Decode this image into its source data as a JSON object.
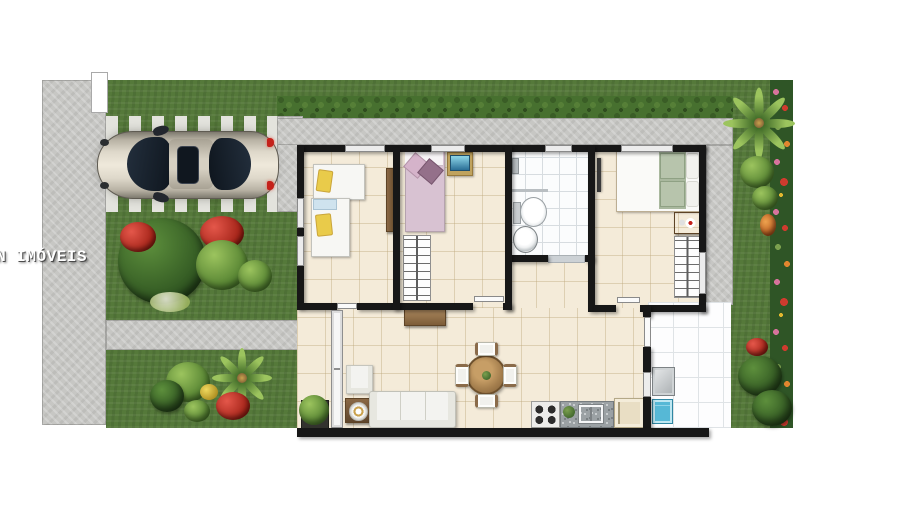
{
  "watermark": {
    "text": "ON IMÓVEIS"
  },
  "palette": {
    "background": "#ffffff",
    "lawn_green": "#55793a",
    "hedge_green": "#2f5526",
    "concrete_gray": "#c7c7c4",
    "paver_white": "#e3e3dd",
    "wall_black": "#171717",
    "floor_beige": "#f4ebd9",
    "tile_white": "#fbfcfd",
    "wood_brown": "#8a6b4a",
    "bed_pink": "#d8c2d2",
    "bed_sage": "#a9b89e",
    "pillow_yellow": "#e9cb4a",
    "sofa_white": "#f3f3f0",
    "washer_blue": "#56b8d6",
    "flower_red": "#cf3b2e",
    "flower_pink": "#d7739c",
    "flower_orange": "#e2862f",
    "car_champagne": "#ded8ca",
    "car_glass": "#1d2733",
    "taillight_red": "#c4211a"
  },
  "scene": {
    "type": "house-floor-plan-top-view",
    "outdoor": [
      "left-sidewalk",
      "gate-pillar",
      "front-lawn",
      "paver-driveway",
      "parked-car",
      "perimeter-walkway",
      "trimmed-bushes",
      "red-flower-shrubs",
      "palm-trees",
      "flowering-side-hedge",
      "back-lawn"
    ],
    "rooms": {
      "bedroom_left": [
        "single-bed",
        "single-bed",
        "tall-cabinet"
      ],
      "bedroom_middle": [
        "single-bed-pink-linen",
        "tv-on-cabinet",
        "open-wardrobe"
      ],
      "bathroom": [
        "shower",
        "toilet",
        "round-washbasin",
        "door-mat"
      ],
      "bedroom_right": [
        "double-bed-sage-linen",
        "wall-mounted-tv",
        "media-cabinet",
        "open-wardrobe"
      ],
      "living_dining": [
        "sliding-glass-door",
        "potted-plant",
        "wood-sideboard",
        "armchair",
        "side-table-with-lamp",
        "three-seat-sofa",
        "round-dining-table",
        "dining-chairs-x4"
      ],
      "kitchen": [
        "four-burner-stove",
        "granite-counter-with-sink",
        "refrigerator"
      ],
      "service_area": [
        "utility-tank",
        "washing-machine"
      ]
    }
  }
}
